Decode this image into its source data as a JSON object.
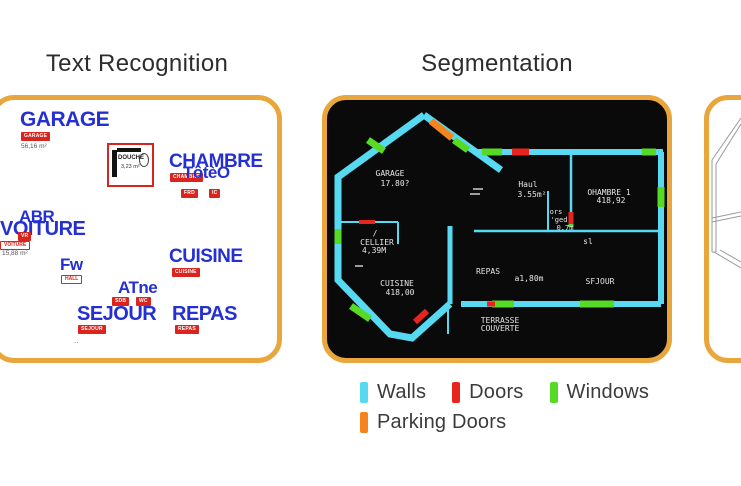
{
  "titles": {
    "left": "Text Recognition",
    "middle": "Segmentation"
  },
  "legend": {
    "items": [
      {
        "label": "Walls",
        "color": "#56d9f1"
      },
      {
        "label": "Doors",
        "color": "#e8241c"
      },
      {
        "label": "Windows",
        "color": "#57da25"
      },
      {
        "label": "Parking Doors",
        "color": "#f5841f"
      }
    ]
  },
  "colors": {
    "panel_border": "#e8a63c",
    "walls": "#56d9f1",
    "doors": "#e8241c",
    "windows": "#57da25",
    "parking_doors": "#f5841f",
    "ocr_text": "#2530d2",
    "gt_label": "#da241e"
  },
  "text_recognition": {
    "garage": "GARAGE",
    "garage_tag": "GARAGE",
    "garage_area": "56,16 m²",
    "douche": "DOUCHE",
    "douche_area": "3,23 m²",
    "chambre": "CHAMBRE",
    "chambre_ocr": "TôtèO",
    "chambre_tag": "CHAMBRE",
    "chambre_tag2": "FRD",
    "chambre_tag3": "IC",
    "abr": "ABR",
    "voiture": "VOITURE",
    "voiture_tag": "VOITURE",
    "voiture_tag_small": "VR",
    "voiture_area": "15,88 m²",
    "fw": "Fw",
    "fw_tag": "HALL",
    "atne": "ATne",
    "atne_tag1": "SDB",
    "atne_tag2": "WC",
    "cuisine": "CUISINE",
    "cuisine_tag": "CUISINE",
    "sejour": "SEJOUR",
    "sejour_tag": "SEJOUR",
    "repas": "REPAS",
    "repas_tag": "REPAS",
    "dots": ".."
  },
  "segmentation": {
    "labels": {
      "garage": "GARAGE",
      "garage_area": "17.80?",
      "hall": "Haul",
      "hall_area": "3.55m²",
      "chambre": "OHAMBRE 1",
      "chambre_area": "418,92",
      "ors": "ors",
      "ged": "'ged",
      "ged_area": "0.7m",
      "sl": "sl",
      "slash": "/",
      "cellier": "CELLIER",
      "cellier_area": "4,39M",
      "cuisine": "CUISINE",
      "cuisine_area": "418,00",
      "repas": "REPAS",
      "dim": "a1,80m",
      "sejour": "SFJOUR",
      "terrasse_line1": "TERRASSE",
      "terrasse_line2": "COUVERTE"
    }
  }
}
